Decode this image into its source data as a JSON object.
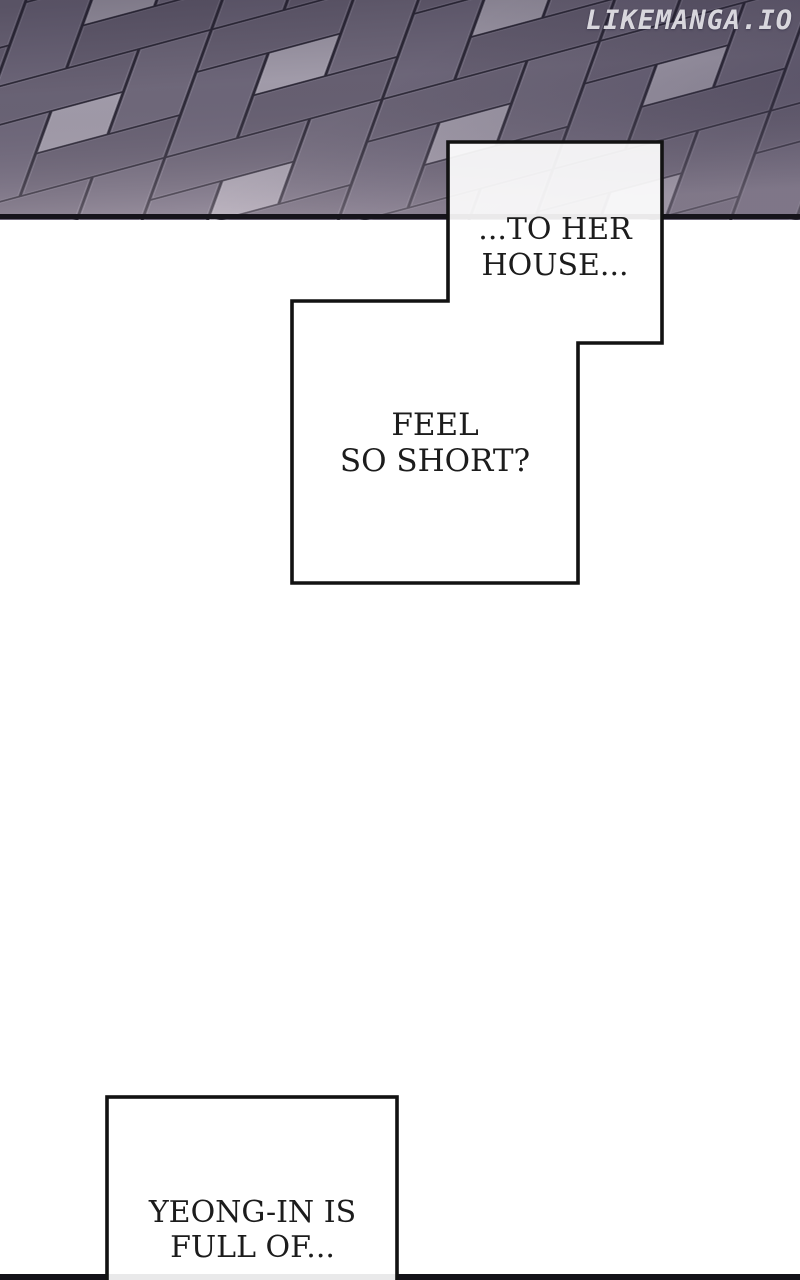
{
  "site": {
    "watermark": "LIKEMANGA.IO"
  },
  "bubbles": {
    "top": {
      "line1": "...TO HER",
      "line2": "HOUSE..."
    },
    "middle": {
      "line1": "FEEL",
      "line2": "SO SHORT?"
    },
    "bottom": {
      "line1": "YEONG-IN IS",
      "line2": "FULL OF..."
    }
  },
  "artwork": {
    "scene": "paved-brick-floor-perspective",
    "colors": {
      "paving_dark": "#6d6678",
      "paving_dark_alt": "#5f5a6e",
      "paving_light_square": "#a8a2b0",
      "paving_joint": "#2d2937",
      "paving_border": "#16141b",
      "panel_border": "#121212",
      "panel_fill": "#ffffff",
      "text": "#1c1c1c",
      "page_background": "#ffffff",
      "watermark": "#f4f3f7"
    }
  }
}
